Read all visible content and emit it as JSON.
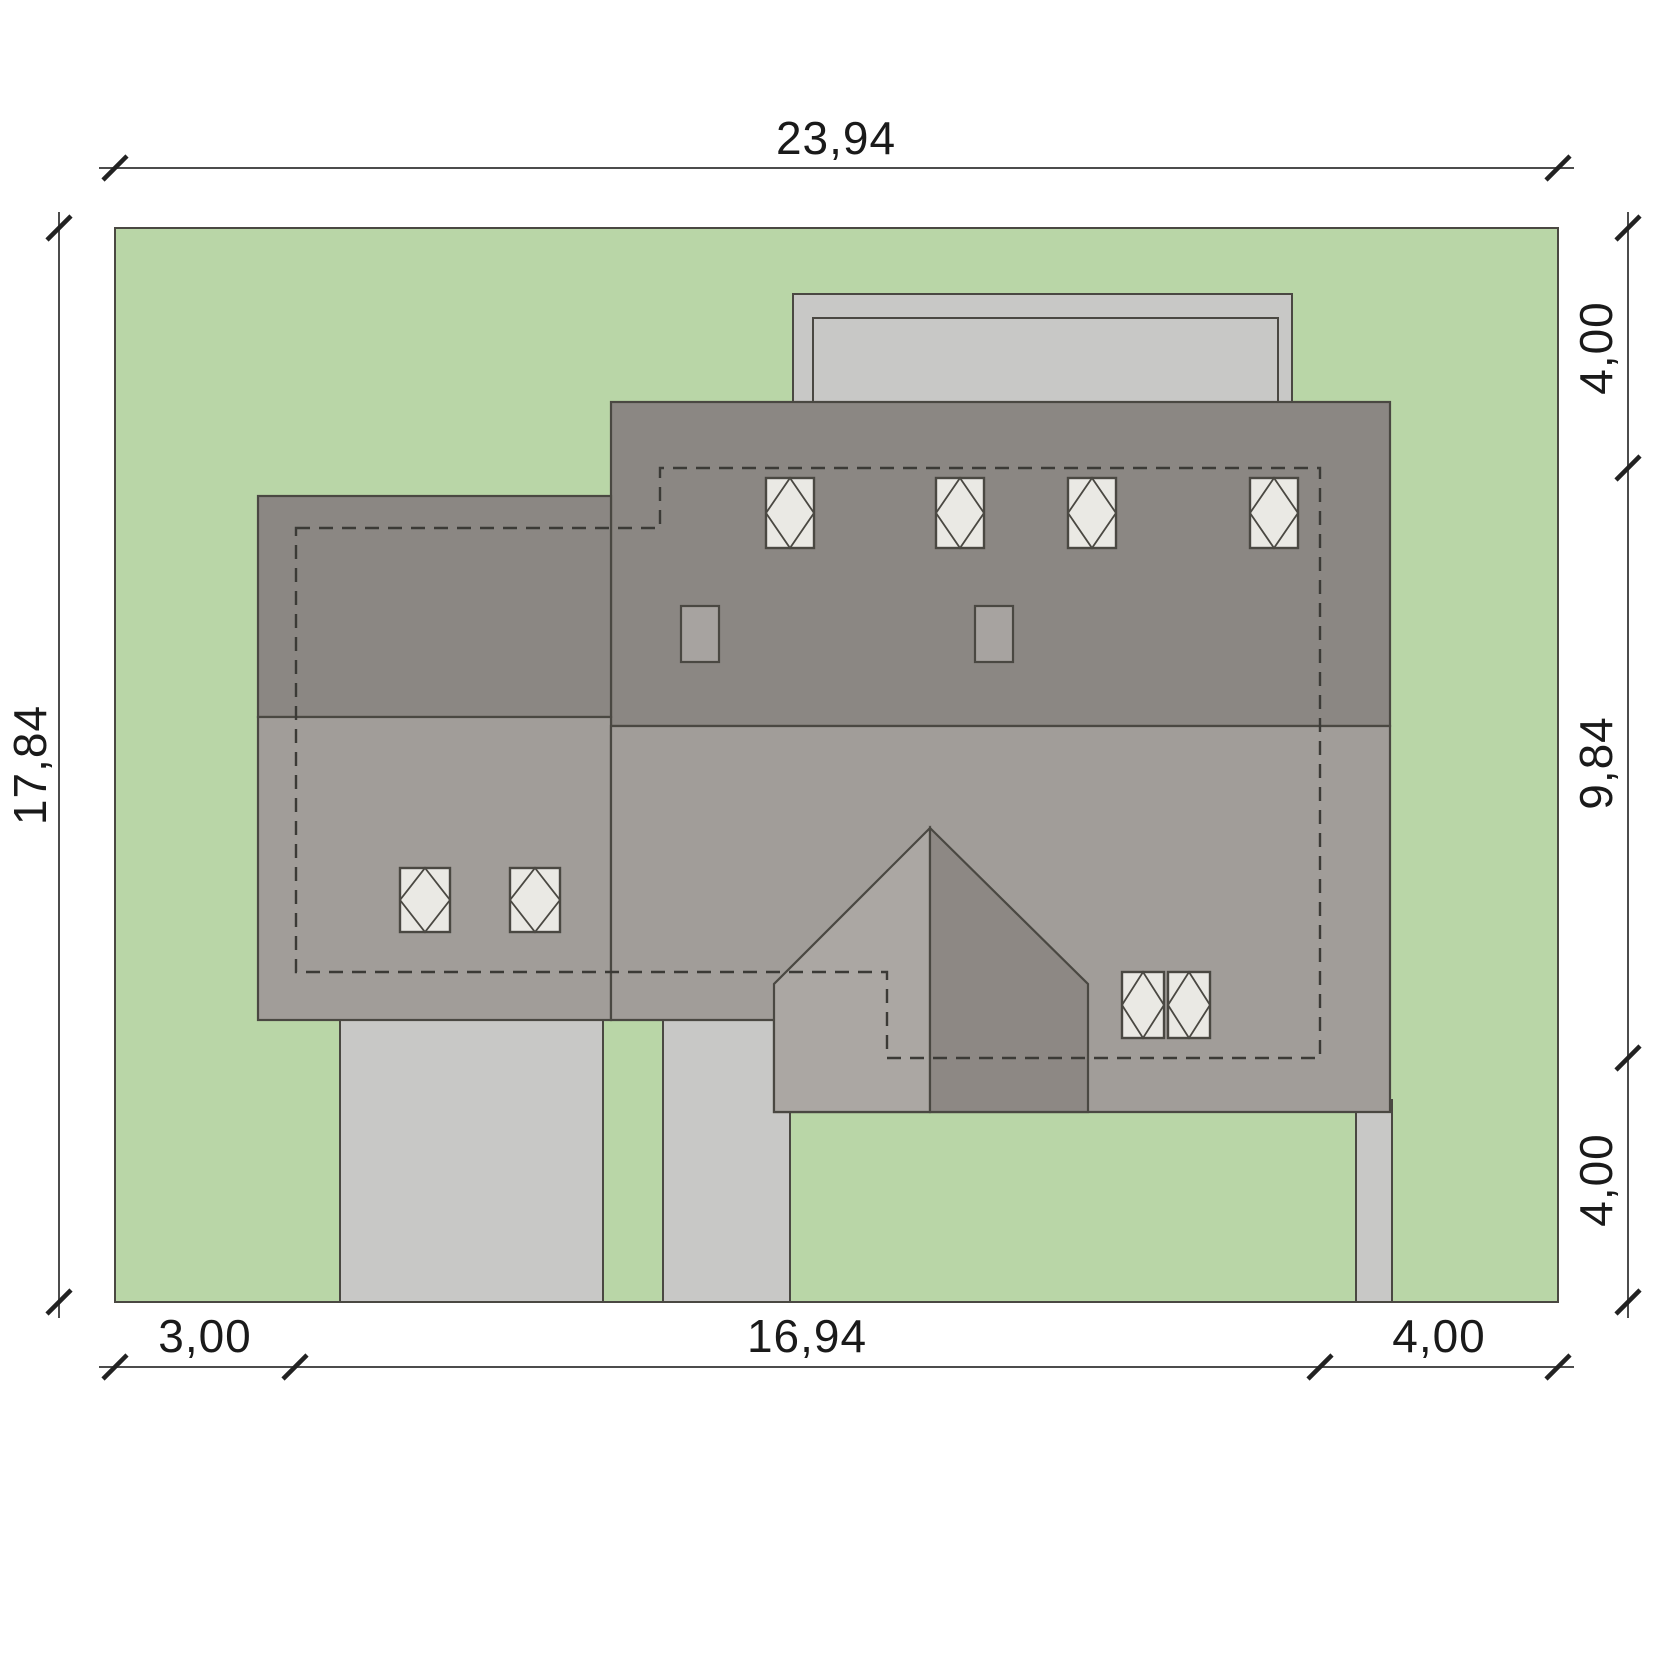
{
  "dimensions": {
    "top": {
      "label": "23,94"
    },
    "left": {
      "label": "17,84"
    },
    "right": {
      "segments": [
        {
          "label": "4,00"
        },
        {
          "label": "9,84"
        },
        {
          "label": "4,00"
        }
      ]
    },
    "bottom": {
      "segments": [
        {
          "label": "3,00"
        },
        {
          "label": "16,94"
        },
        {
          "label": "4,00"
        }
      ]
    }
  },
  "features": {
    "skylights_upper_roof": 4,
    "skylights_left_wing": 2,
    "skylights_lower_pair": 2,
    "chimneys": 2,
    "has_terrace": true,
    "has_driveway": true,
    "has_walkways": true,
    "wall_outline_style": "dashed"
  },
  "colors": {
    "background": "#ffffff",
    "grass": "#b9d6a7",
    "roof_dark": "#8b8783",
    "roof_mid": "#a19d99",
    "bay_left": "#aba7a3",
    "bay_right": "#8d8884",
    "paving": "#c8c8c6",
    "skylight": "#eae9e4",
    "chimney": "#a7a3a0",
    "outline": "#4a4842",
    "dashed_wall": "#3b3a36",
    "dim_line": "#4c4c4c",
    "tick": "#222222",
    "dim_text": "#1a1a1a"
  }
}
